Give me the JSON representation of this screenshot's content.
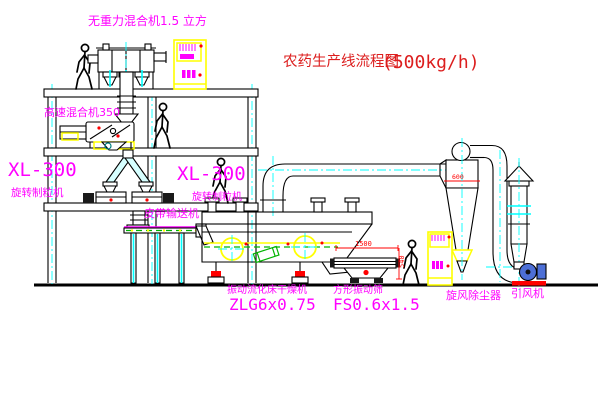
{
  "title": {
    "text": "农药生产线流程图",
    "capacity": "(500kg/h)"
  },
  "labels": {
    "gravity_mixer": "无重力混合机1.5 立方",
    "high_speed_mixer": "高速混合机350",
    "granulator_left_model": "XL-300",
    "granulator_left_name": "旋转制粒机",
    "granulator_right_model": "XL-300",
    "granulator_right_name": "旋转制粒机",
    "belt_conveyor": "皮带输送机",
    "dryer_name": "振动流化床干燥机",
    "dryer_model": "ZLG6x0.75",
    "screen_name": "方形振动筛",
    "screen_model": "FS0.6x1.5",
    "cyclone": "旋风除尘器",
    "fan": "引风机"
  },
  "dimensions": {
    "screen_length": "1500",
    "screen_height": "540",
    "cyclone_body": "600"
  },
  "colors": {
    "label_magenta": "#FF00FF",
    "title_red": "#DC1E1E",
    "dimension_red": "#FF0000",
    "cad_yellow": "#FFFF00",
    "cad_cyan": "#00FFFF",
    "cad_green": "#00B400",
    "line_black": "#000000"
  }
}
